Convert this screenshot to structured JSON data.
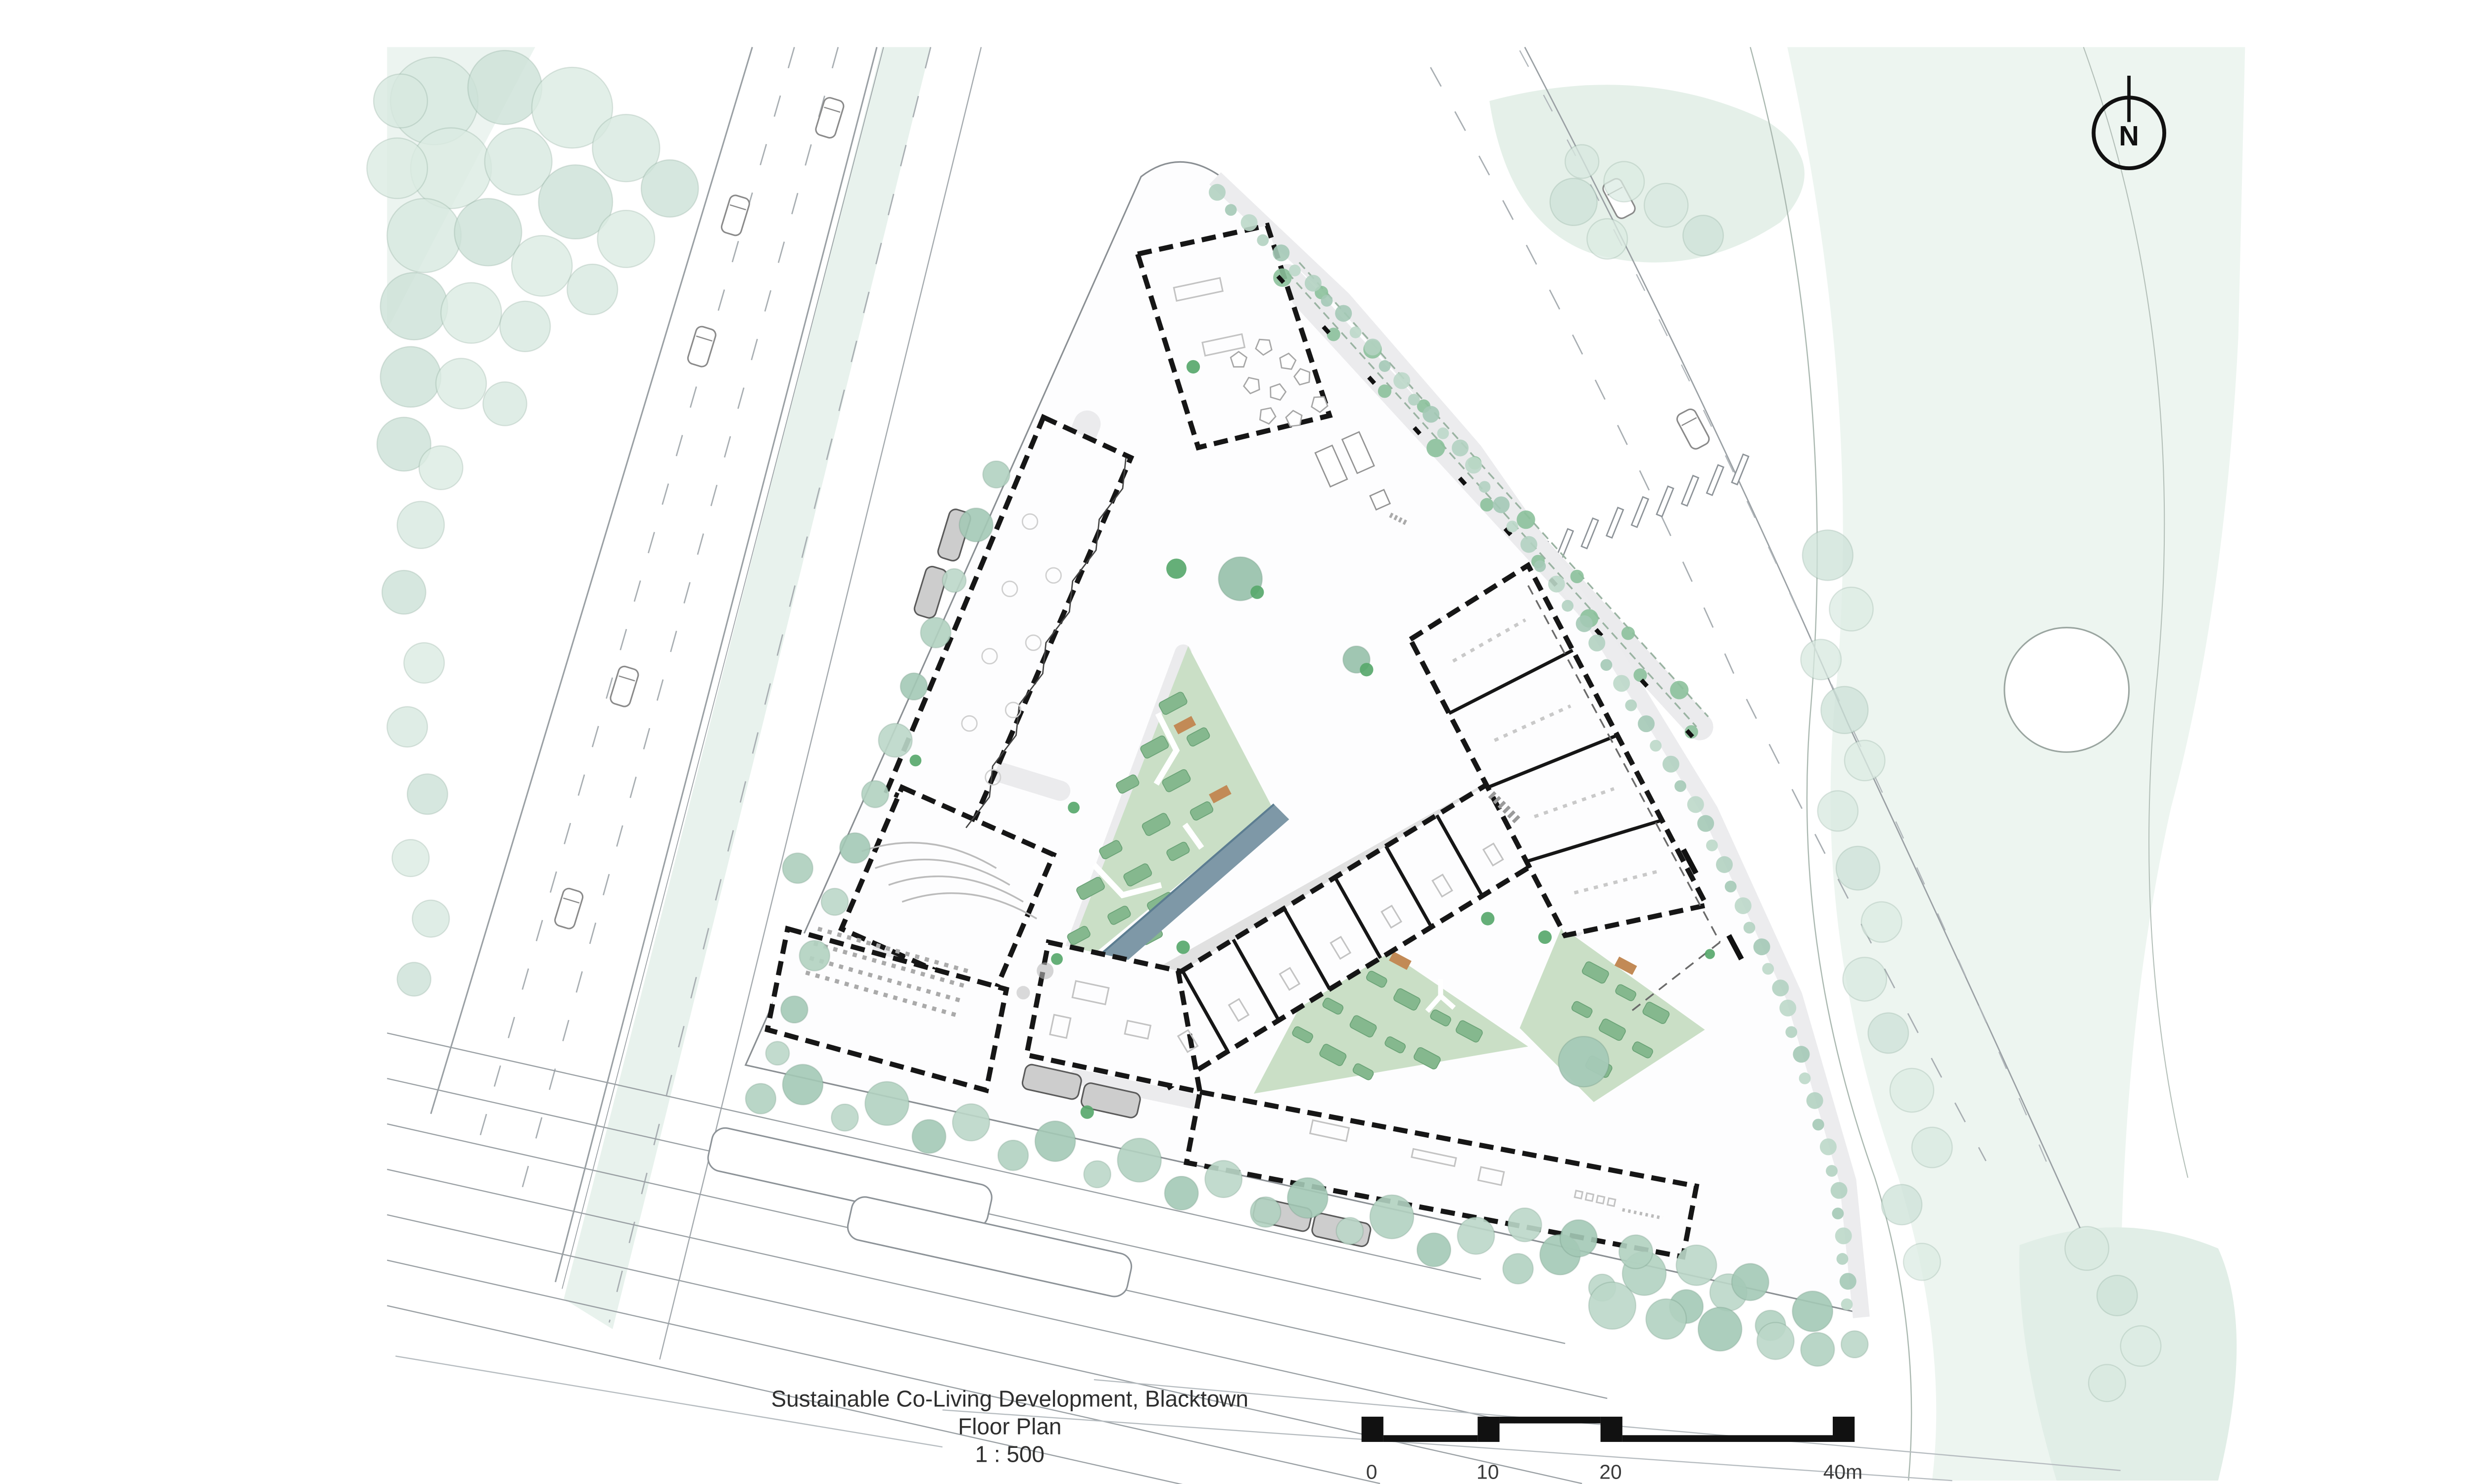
{
  "document": {
    "title": "Sustainable Co-Living Development, Blacktown",
    "subtitle": "Floor Plan",
    "scale": "1 : 500"
  },
  "north_arrow": {
    "label": "N"
  },
  "scale_bar": {
    "unit_labels": [
      "0",
      "10",
      "20",
      "40m"
    ],
    "values_m": [
      0,
      10,
      20,
      40
    ]
  },
  "palette": {
    "building_wall": "#161616",
    "paving": "#ebebed",
    "courtyard_green": "#cadfc6",
    "planting_bed": "#85b88e",
    "water": "#7e98a7",
    "street_tree": "#b2d2c1",
    "park_green": "#e5f0e9",
    "accent_shrub": "#58a86c",
    "timber_bench": "#c28a56",
    "vehicle_grey": "#cdcdcd"
  }
}
